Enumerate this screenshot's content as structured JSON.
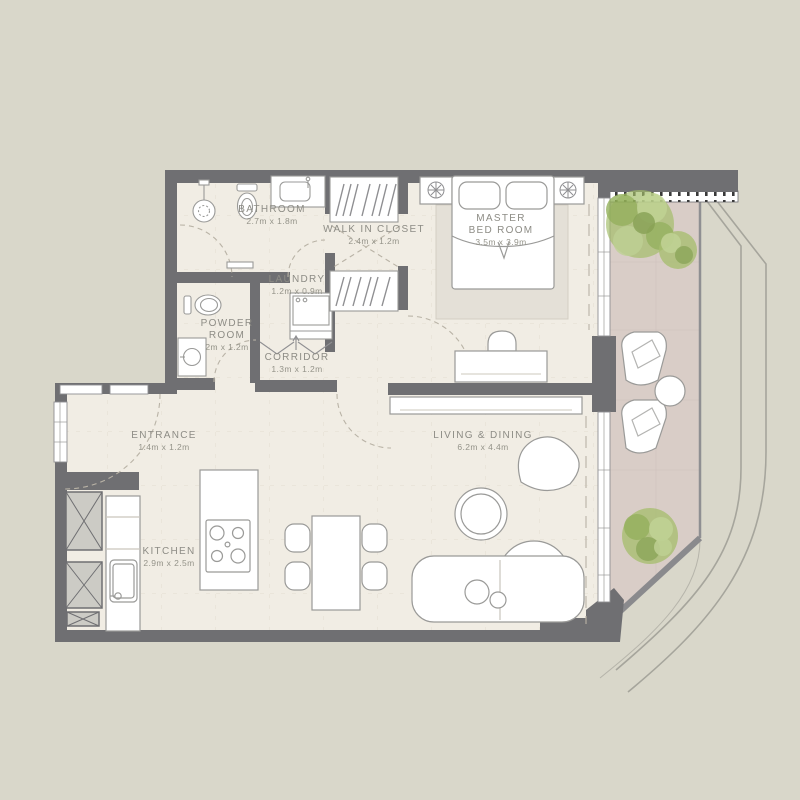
{
  "plan_title": "apartment-unit-floor-plan",
  "colors": {
    "background": "#d9d7ca",
    "wall": "#6f6f72",
    "interior_floor": "#f1ede4",
    "balcony_floor": "#d9cdc7",
    "rug": "#e4e0d7",
    "shaft_fill": "#cccbc5",
    "furniture_outline": "#9a9a98",
    "label_text": "#8d8c85",
    "tree_green": "#9cb961",
    "facade_line": "#a6a59c"
  },
  "rooms": {
    "bathroom": {
      "name": "BATHROOM",
      "dims": "2.7m x 1.8m"
    },
    "walk_in_closet": {
      "name": "WALK IN CLOSET",
      "dims": "2.4m x 1.2m"
    },
    "laundry": {
      "name": "LAUNDRY",
      "dims": "1.2m x 0.9m"
    },
    "master_bedroom": {
      "name_line1": "MASTER",
      "name_line2": "BED ROOM",
      "dims": "3.5m x 3.9m"
    },
    "powder_room": {
      "name_line1": "POWDER",
      "name_line2": "ROOM",
      "dims": "2m x 1.2m"
    },
    "corridor": {
      "name": "CORRIDOR",
      "dims": "1.3m x 1.2m"
    },
    "entrance": {
      "name": "ENTRANCE",
      "dims": "1.4m x 1.2m"
    },
    "living_dining": {
      "name": "LIVING & DINING",
      "dims": "6.2m x 4.4m"
    },
    "kitchen": {
      "name": "KITCHEN",
      "dims": "2.9m x 2.5m"
    }
  },
  "furniture_icons": [
    "shower-icon",
    "toilet-icon",
    "vanity-sink-icon",
    "wardrobe-icon",
    "washing-machine-icon",
    "bed-icon",
    "nightstand-icon",
    "ceiling-lamp-icon",
    "desk-icon",
    "desk-chair-icon",
    "tv-console-icon",
    "dining-table-icon",
    "dining-chair-icon",
    "sofa-icon",
    "coffee-table-icon",
    "armchair-icon",
    "kitchen-island-icon",
    "cooktop-icon",
    "kitchen-sink-icon",
    "service-shaft-icon",
    "lounge-chair-icon",
    "patio-table-icon",
    "tree-icon",
    "balcony-railing"
  ]
}
